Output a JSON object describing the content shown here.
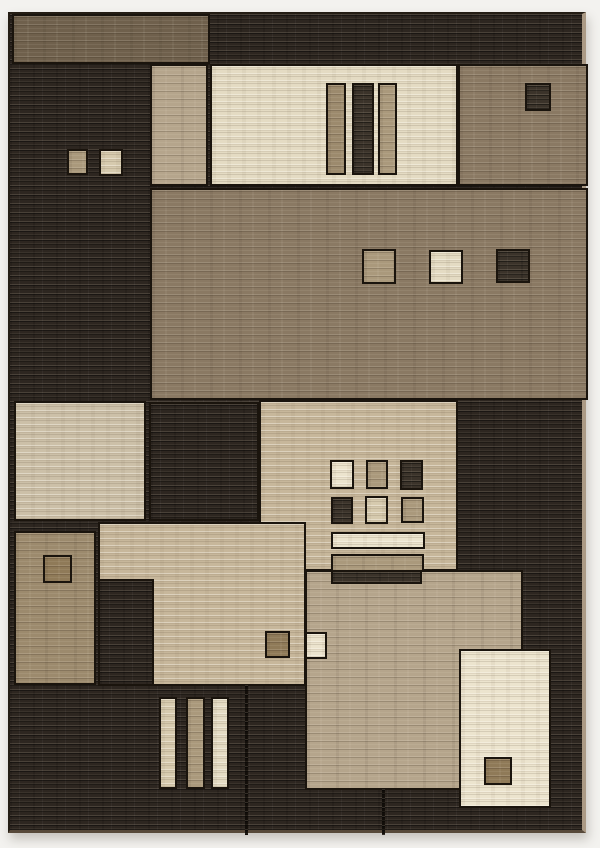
{
  "image": {
    "subject": "Abstract geometric area rug product photo",
    "style": "Overlapping rectangular color blocks with small accent squares and bar motifs",
    "background_color": "#f3f2ef"
  },
  "palette": {
    "dark": "#2d2620",
    "darksq": "#3b332a",
    "browndark": "#6f604c",
    "brown": "#8a7963",
    "tan": "#b5a58c",
    "tanmid": "#aa997c",
    "tandark": "#9c8a6d",
    "umber": "#8f7a58",
    "beige": "#c7b79b",
    "beigelight": "#d6caae",
    "greige": "#ccc0a8",
    "cream": "#e4dbc3",
    "creambright": "#ece4ce",
    "seam": "#15100b",
    "outline": "#1a140d",
    "edge": "#ab9a85"
  },
  "rug": {
    "frame": {
      "x": 8,
      "y": 12,
      "w": 578,
      "h": 821
    },
    "base_tone": "dark",
    "blocks": [
      {
        "n": "top-brown-block",
        "t": "browndark",
        "x": 2,
        "y": 0,
        "w": 198,
        "h": 50
      },
      {
        "n": "upper-tan-strip",
        "t": "tan",
        "x": 140,
        "y": 50,
        "w": 58,
        "h": 122
      },
      {
        "n": "upper-cream-panel",
        "t": "cream",
        "x": 200,
        "y": 50,
        "w": 248,
        "h": 122
      },
      {
        "n": "upper-panel-bar-tan",
        "t": "tandark",
        "x": 316,
        "y": 69,
        "w": 20,
        "h": 92
      },
      {
        "n": "upper-panel-bar-dark",
        "t": "darksq",
        "x": 342,
        "y": 69,
        "w": 22,
        "h": 92
      },
      {
        "n": "upper-panel-bar-brown",
        "t": "tanmid",
        "x": 368,
        "y": 69,
        "w": 19,
        "h": 92
      },
      {
        "n": "upper-brown-panel",
        "t": "brown",
        "x": 448,
        "y": 50,
        "w": 130,
        "h": 122
      },
      {
        "n": "upper-dark-square",
        "t": "darksq",
        "x": 515,
        "y": 69,
        "w": 26,
        "h": 28
      },
      {
        "n": "left-square-tan",
        "t": "tanmid",
        "x": 57,
        "y": 135,
        "w": 21,
        "h": 26
      },
      {
        "n": "left-square-beige",
        "t": "beigelight",
        "x": 89,
        "y": 135,
        "w": 24,
        "h": 27
      },
      {
        "n": "center-brown-field",
        "t": "brown",
        "x": 140,
        "y": 174,
        "w": 438,
        "h": 212
      },
      {
        "n": "field-square-tan",
        "t": "tanmid",
        "x": 352,
        "y": 235,
        "w": 34,
        "h": 35
      },
      {
        "n": "field-square-cream",
        "t": "cream",
        "x": 419,
        "y": 236,
        "w": 34,
        "h": 34
      },
      {
        "n": "field-square-dark",
        "t": "darksq",
        "x": 486,
        "y": 235,
        "w": 34,
        "h": 34
      },
      {
        "n": "mid-greige-block",
        "t": "greige",
        "x": 4,
        "y": 387,
        "w": 132,
        "h": 120
      },
      {
        "n": "mid-dark-block",
        "t": "dark",
        "x": 139,
        "y": 388,
        "w": 110,
        "h": 119
      },
      {
        "n": "mid-beige-panel",
        "t": "beige",
        "x": 249,
        "y": 386,
        "w": 199,
        "h": 171
      },
      {
        "n": "lower-beige-block",
        "t": "beige",
        "x": 88,
        "y": 508,
        "w": 208,
        "h": 164
      },
      {
        "n": "lower-tan-block",
        "t": "tandark",
        "x": 4,
        "y": 517,
        "w": 82,
        "h": 154
      },
      {
        "n": "tan-outline-square",
        "t": "umber",
        "x": 33,
        "y": 541,
        "w": 29,
        "h": 28
      },
      {
        "n": "lower-dark-strip",
        "t": "dark",
        "x": 88,
        "y": 565,
        "w": 56,
        "h": 107
      },
      {
        "n": "lower-tan-field",
        "t": "tan",
        "x": 295,
        "y": 556,
        "w": 218,
        "h": 220
      },
      {
        "n": "grid-square-cream",
        "t": "creambright",
        "x": 320,
        "y": 446,
        "w": 24,
        "h": 29
      },
      {
        "n": "grid-square-tan",
        "t": "tanmid",
        "x": 356,
        "y": 446,
        "w": 22,
        "h": 29
      },
      {
        "n": "grid-square-dark",
        "t": "darksq",
        "x": 390,
        "y": 446,
        "w": 23,
        "h": 30
      },
      {
        "n": "grid-square-dark-2",
        "t": "darksq",
        "x": 321,
        "y": 483,
        "w": 22,
        "h": 27
      },
      {
        "n": "grid-square-beige",
        "t": "beigelight",
        "x": 355,
        "y": 482,
        "w": 23,
        "h": 28
      },
      {
        "n": "grid-square-tan-2",
        "t": "tanmid",
        "x": 391,
        "y": 483,
        "w": 23,
        "h": 26
      },
      {
        "n": "stack-bar-cream",
        "t": "creambright",
        "x": 321,
        "y": 518,
        "w": 94,
        "h": 17
      },
      {
        "n": "stack-bar-tan",
        "t": "tanmid",
        "x": 321,
        "y": 540,
        "w": 93,
        "h": 18
      },
      {
        "n": "stack-bar-dark",
        "t": "darksq",
        "x": 321,
        "y": 556,
        "w": 91,
        "h": 14
      },
      {
        "n": "small-square-brown",
        "t": "umber",
        "x": 255,
        "y": 617,
        "w": 25,
        "h": 27
      },
      {
        "n": "small-square-cream",
        "t": "creambright",
        "x": 295,
        "y": 618,
        "w": 22,
        "h": 27
      },
      {
        "n": "bottom-cream-panel",
        "t": "creambright",
        "x": 449,
        "y": 635,
        "w": 92,
        "h": 159
      },
      {
        "n": "bottom-panel-square",
        "t": "umber",
        "x": 474,
        "y": 743,
        "w": 28,
        "h": 28
      },
      {
        "n": "bottom-bar-beige",
        "t": "beigelight",
        "x": 149,
        "y": 683,
        "w": 18,
        "h": 92
      },
      {
        "n": "bottom-bar-tan",
        "t": "tanmid",
        "x": 176,
        "y": 683,
        "w": 19,
        "h": 92
      },
      {
        "n": "bottom-bar-cream",
        "t": "cream",
        "x": 201,
        "y": 683,
        "w": 18,
        "h": 92
      },
      {
        "n": "seam-line-left",
        "t": "seam",
        "x": 235,
        "y": 671,
        "w": 3,
        "h": 150,
        "nb": true
      },
      {
        "n": "seam-line-right",
        "t": "seam",
        "x": 372,
        "y": 775,
        "w": 3,
        "h": 46,
        "nb": true
      }
    ]
  }
}
